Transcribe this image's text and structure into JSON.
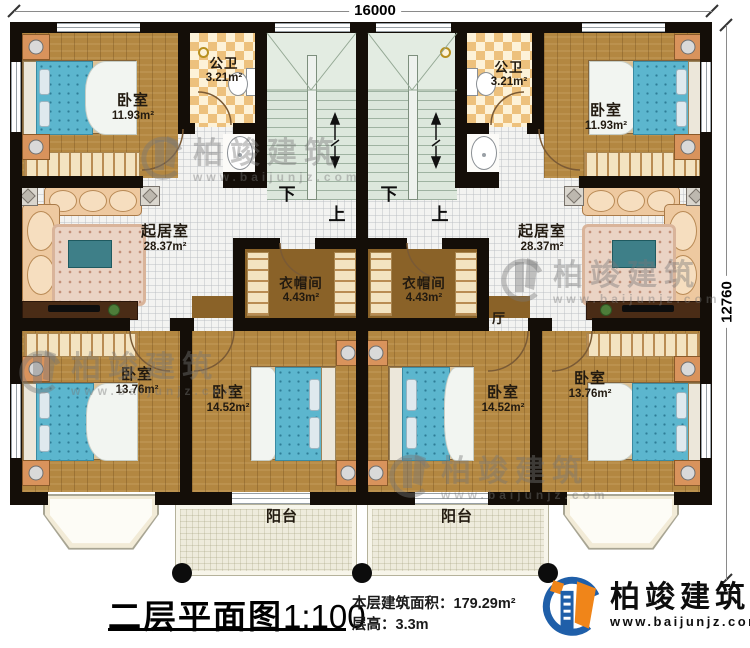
{
  "dimensions": {
    "width": "16000",
    "height": "12760"
  },
  "stairs": {
    "down": "下",
    "up": "上"
  },
  "hall": {
    "label": "厅"
  },
  "rooms": {
    "bedroom_tl": {
      "label": "卧室",
      "area": "11.93m²"
    },
    "bedroom_tr": {
      "label": "卧室",
      "area": "11.93m²"
    },
    "bath_left": {
      "label": "公卫",
      "area": "3.21m²"
    },
    "bath_right": {
      "label": "公卫",
      "area": "3.21m²"
    },
    "living_left": {
      "label": "起居室",
      "area": "28.37m²"
    },
    "living_right": {
      "label": "起居室",
      "area": "28.37m²"
    },
    "closet_left": {
      "label": "衣帽间",
      "area": "4.43m²"
    },
    "closet_right": {
      "label": "衣帽间",
      "area": "4.43m²"
    },
    "bedroom_bl": {
      "label": "卧室",
      "area": "13.76m²"
    },
    "bedroom_ml": {
      "label": "卧室",
      "area": "14.52m²"
    },
    "bedroom_mr": {
      "label": "卧室",
      "area": "14.52m²"
    },
    "bedroom_br": {
      "label": "卧室",
      "area": "13.76m²"
    },
    "balcony_left": {
      "label": "阳台"
    },
    "balcony_right": {
      "label": "阳台"
    }
  },
  "title_block": {
    "title": "二层平面图",
    "scale": "1:100",
    "area_label": "本层建筑面积：",
    "area_value": "179.29m²",
    "height_label": "层高：",
    "height_value": "3.3m"
  },
  "logo": {
    "brand": "柏竣建筑",
    "website": "www.baijunjz.com"
  },
  "watermark": {
    "brand": "柏竣建筑",
    "website": "www.baijunjz.com"
  }
}
